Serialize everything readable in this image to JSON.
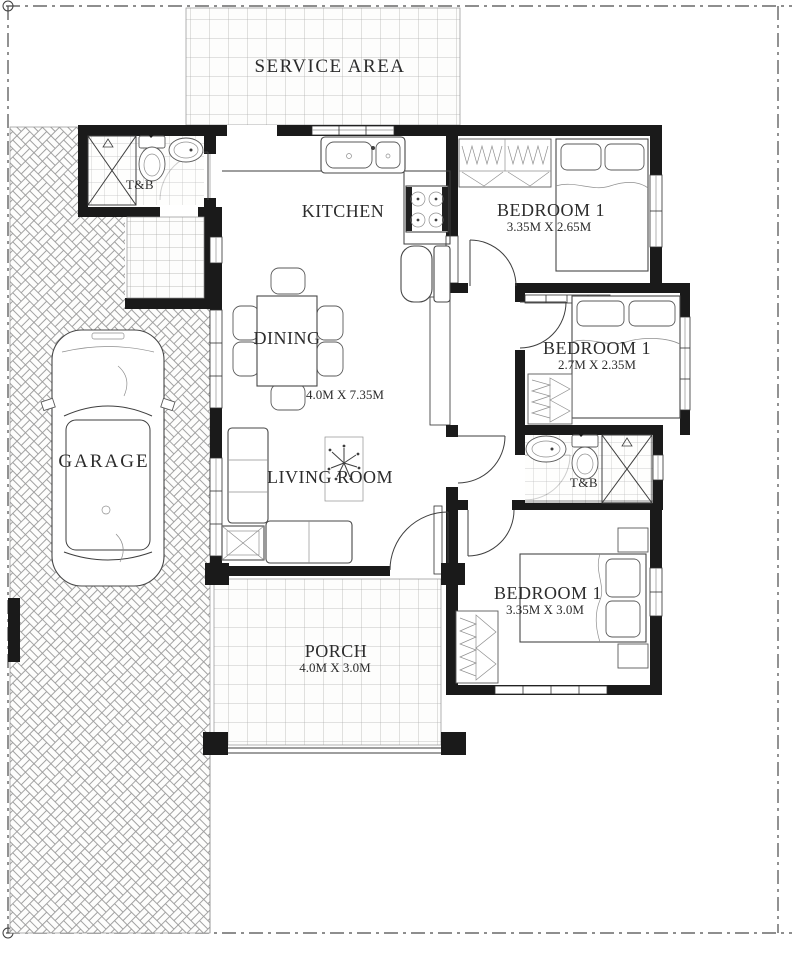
{
  "site": {
    "service_area": {
      "label": "SERVICE AREA"
    },
    "garage": {
      "label": "GARAGE"
    }
  },
  "rooms": {
    "kitchen": {
      "label": "KITCHEN"
    },
    "dining": {
      "label": "DINING",
      "dims": "4.0M X 7.35M"
    },
    "living_room": {
      "label": "LIVING ROOM"
    },
    "bedroom_top": {
      "label": "BEDROOM 1",
      "dims": "3.35M X 2.65M"
    },
    "bedroom_middle": {
      "label": "BEDROOM 1",
      "dims": "2.7M X 2.35M"
    },
    "bedroom_bottom": {
      "label": "BEDROOM 1",
      "dims": "3.35M X 3.0M"
    },
    "toilet_bath_upper": {
      "label": "T&B"
    },
    "toilet_bath_lower": {
      "label": "T&B"
    },
    "porch": {
      "label": "PORCH",
      "dims": "4.0M X 3.0M"
    }
  },
  "colors": {
    "wall": "#1a1a1a",
    "line": "#3e3e3e",
    "tile_line": "#b3b3b3",
    "paper": "#ffffff",
    "text": "#2c2c2c"
  }
}
